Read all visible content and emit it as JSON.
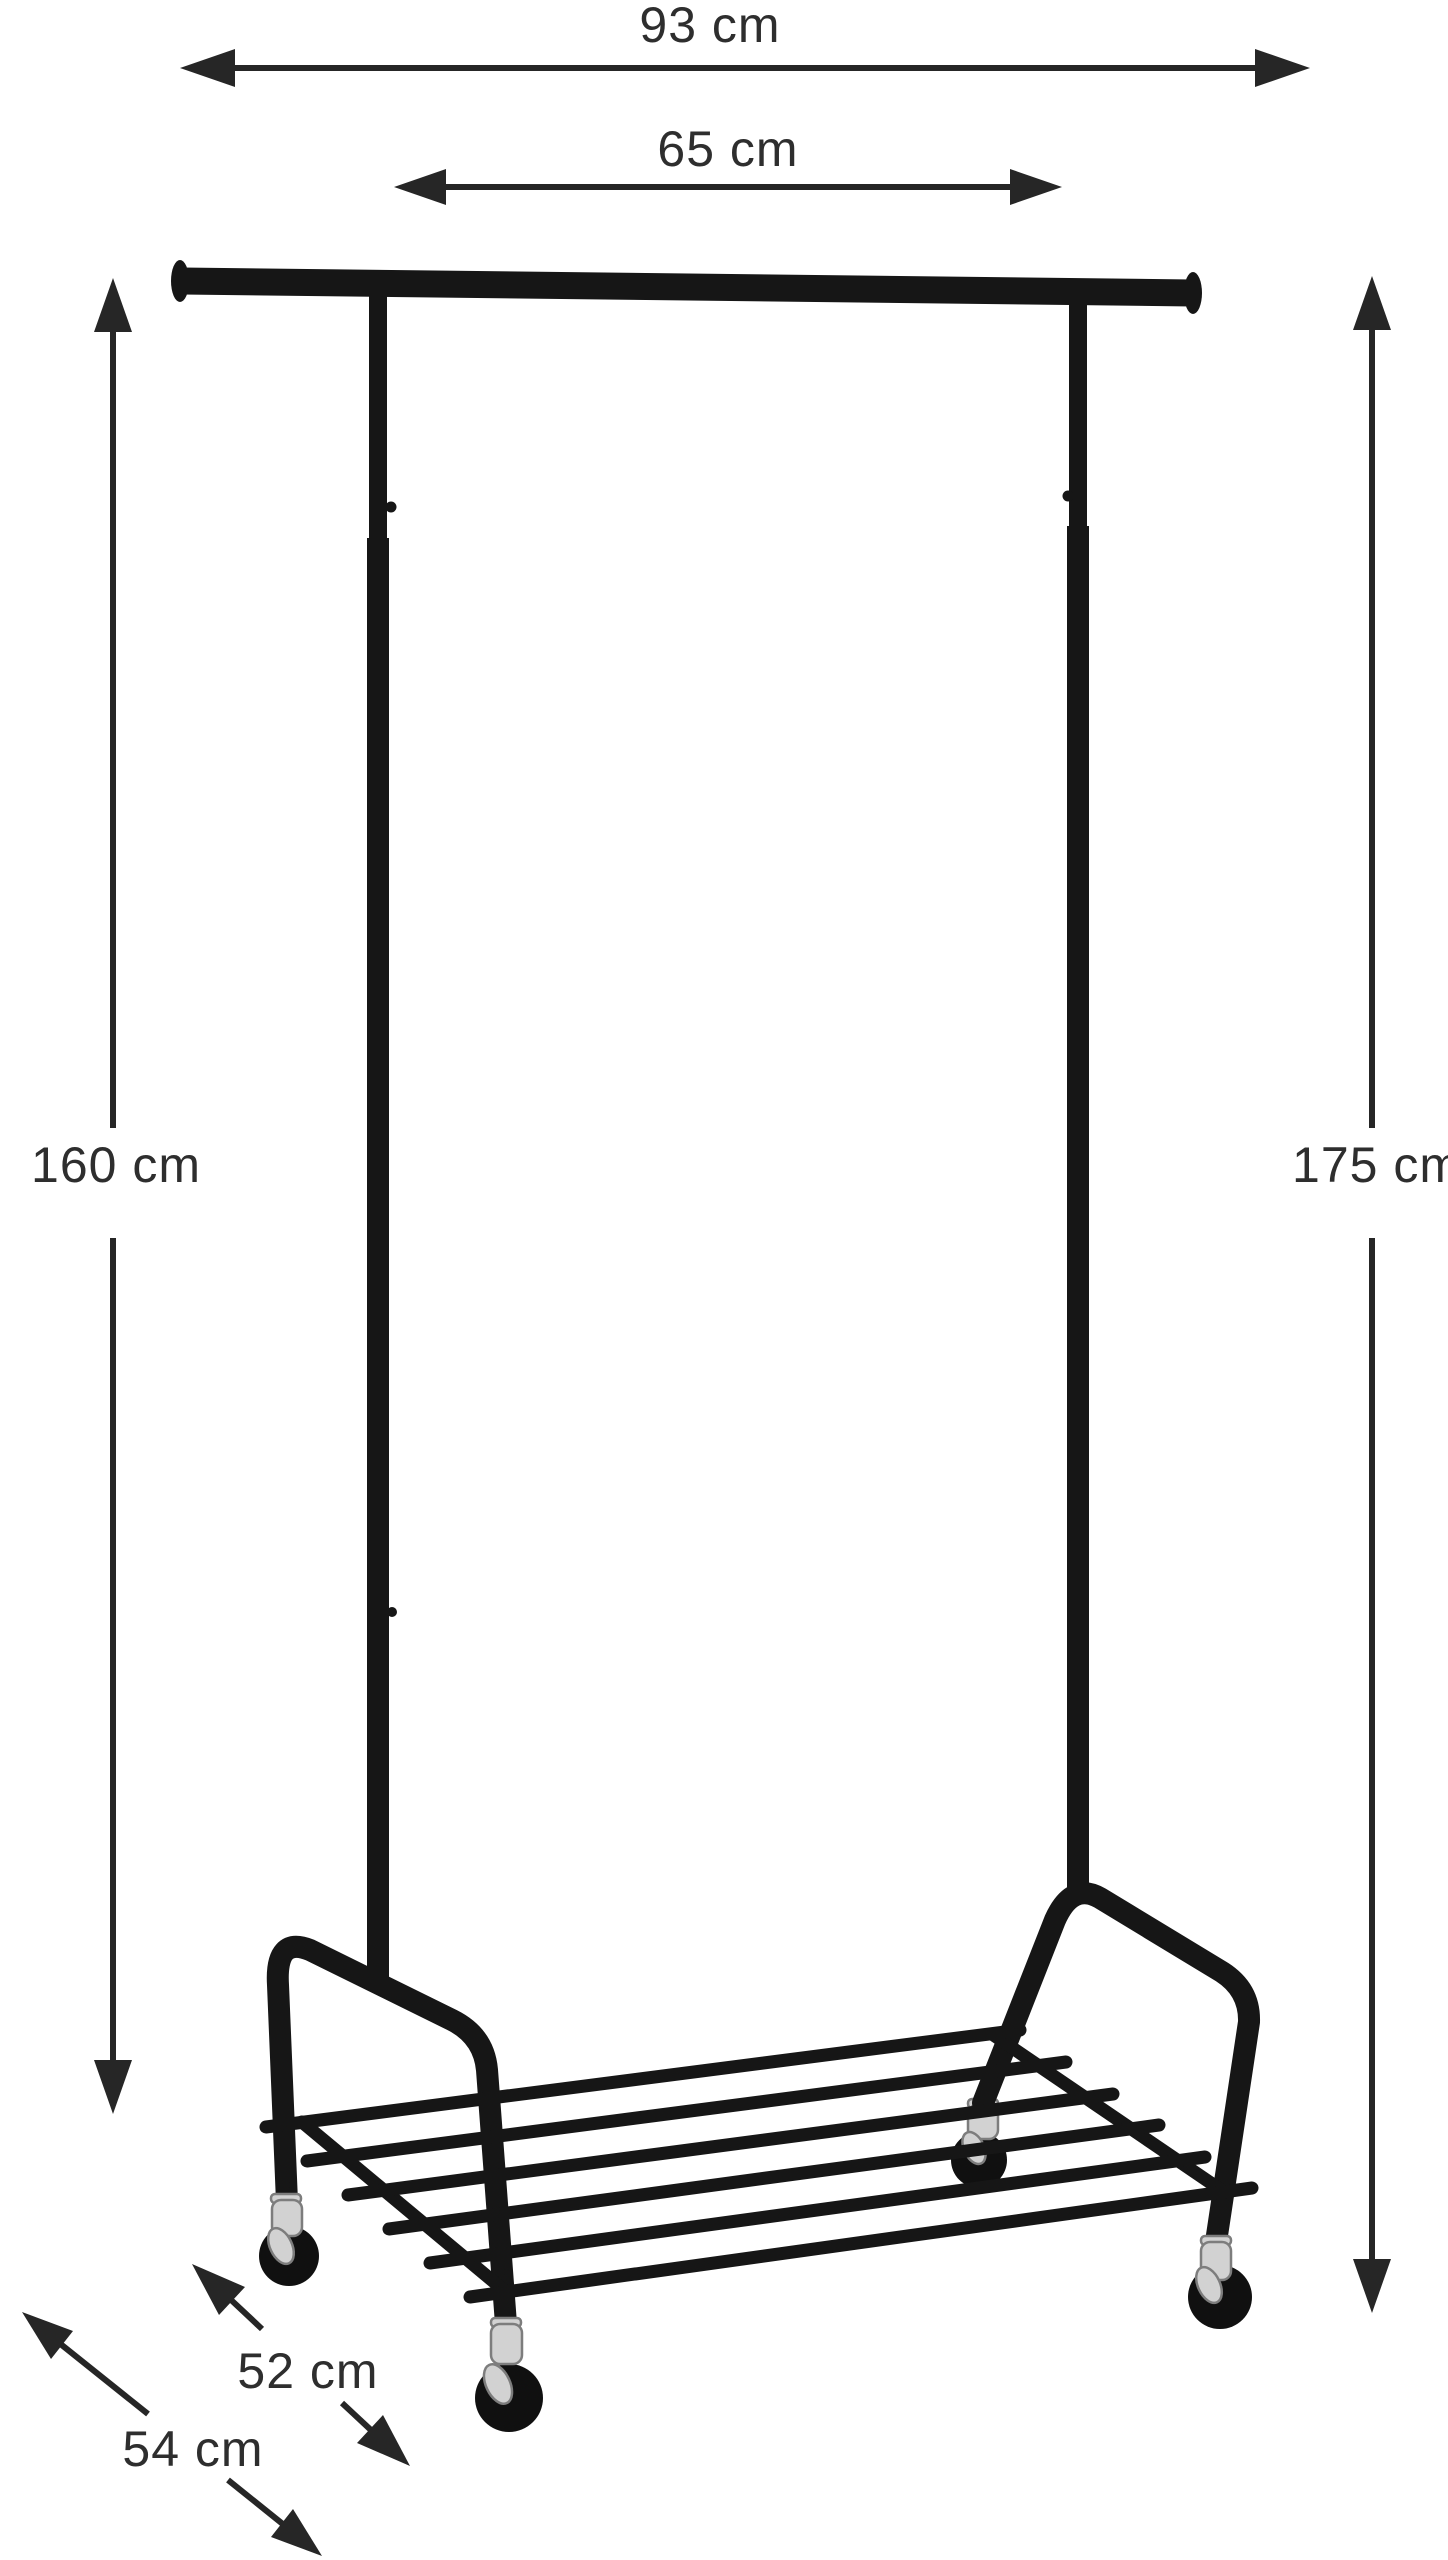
{
  "figure": {
    "object": "garment-rack-on-casters",
    "style": "product-dimension-diagram",
    "unit": "cm"
  },
  "colors": {
    "background": "#ffffff",
    "line_art": "#161616",
    "dimension_arrows": "#262626",
    "label_text": "#2e2e2e",
    "caster_chrome": "#d2d2d2",
    "caster_wheel": "#101010"
  },
  "dimensions": [
    {
      "id": "top-width",
      "label": "93 cm",
      "value_cm": 93,
      "orientation": "horizontal"
    },
    {
      "id": "hanger-width",
      "label": "65 cm",
      "value_cm": 65,
      "orientation": "horizontal"
    },
    {
      "id": "height-left",
      "label": "160 cm",
      "value_cm": 160,
      "orientation": "vertical"
    },
    {
      "id": "height-right",
      "label": "175 cm",
      "value_cm": 175,
      "orientation": "vertical"
    },
    {
      "id": "depth-upper",
      "label": "52 cm",
      "value_cm": 52,
      "orientation": "diagonal"
    },
    {
      "id": "depth-lower",
      "label": "54 cm",
      "value_cm": 54,
      "orientation": "diagonal"
    }
  ]
}
